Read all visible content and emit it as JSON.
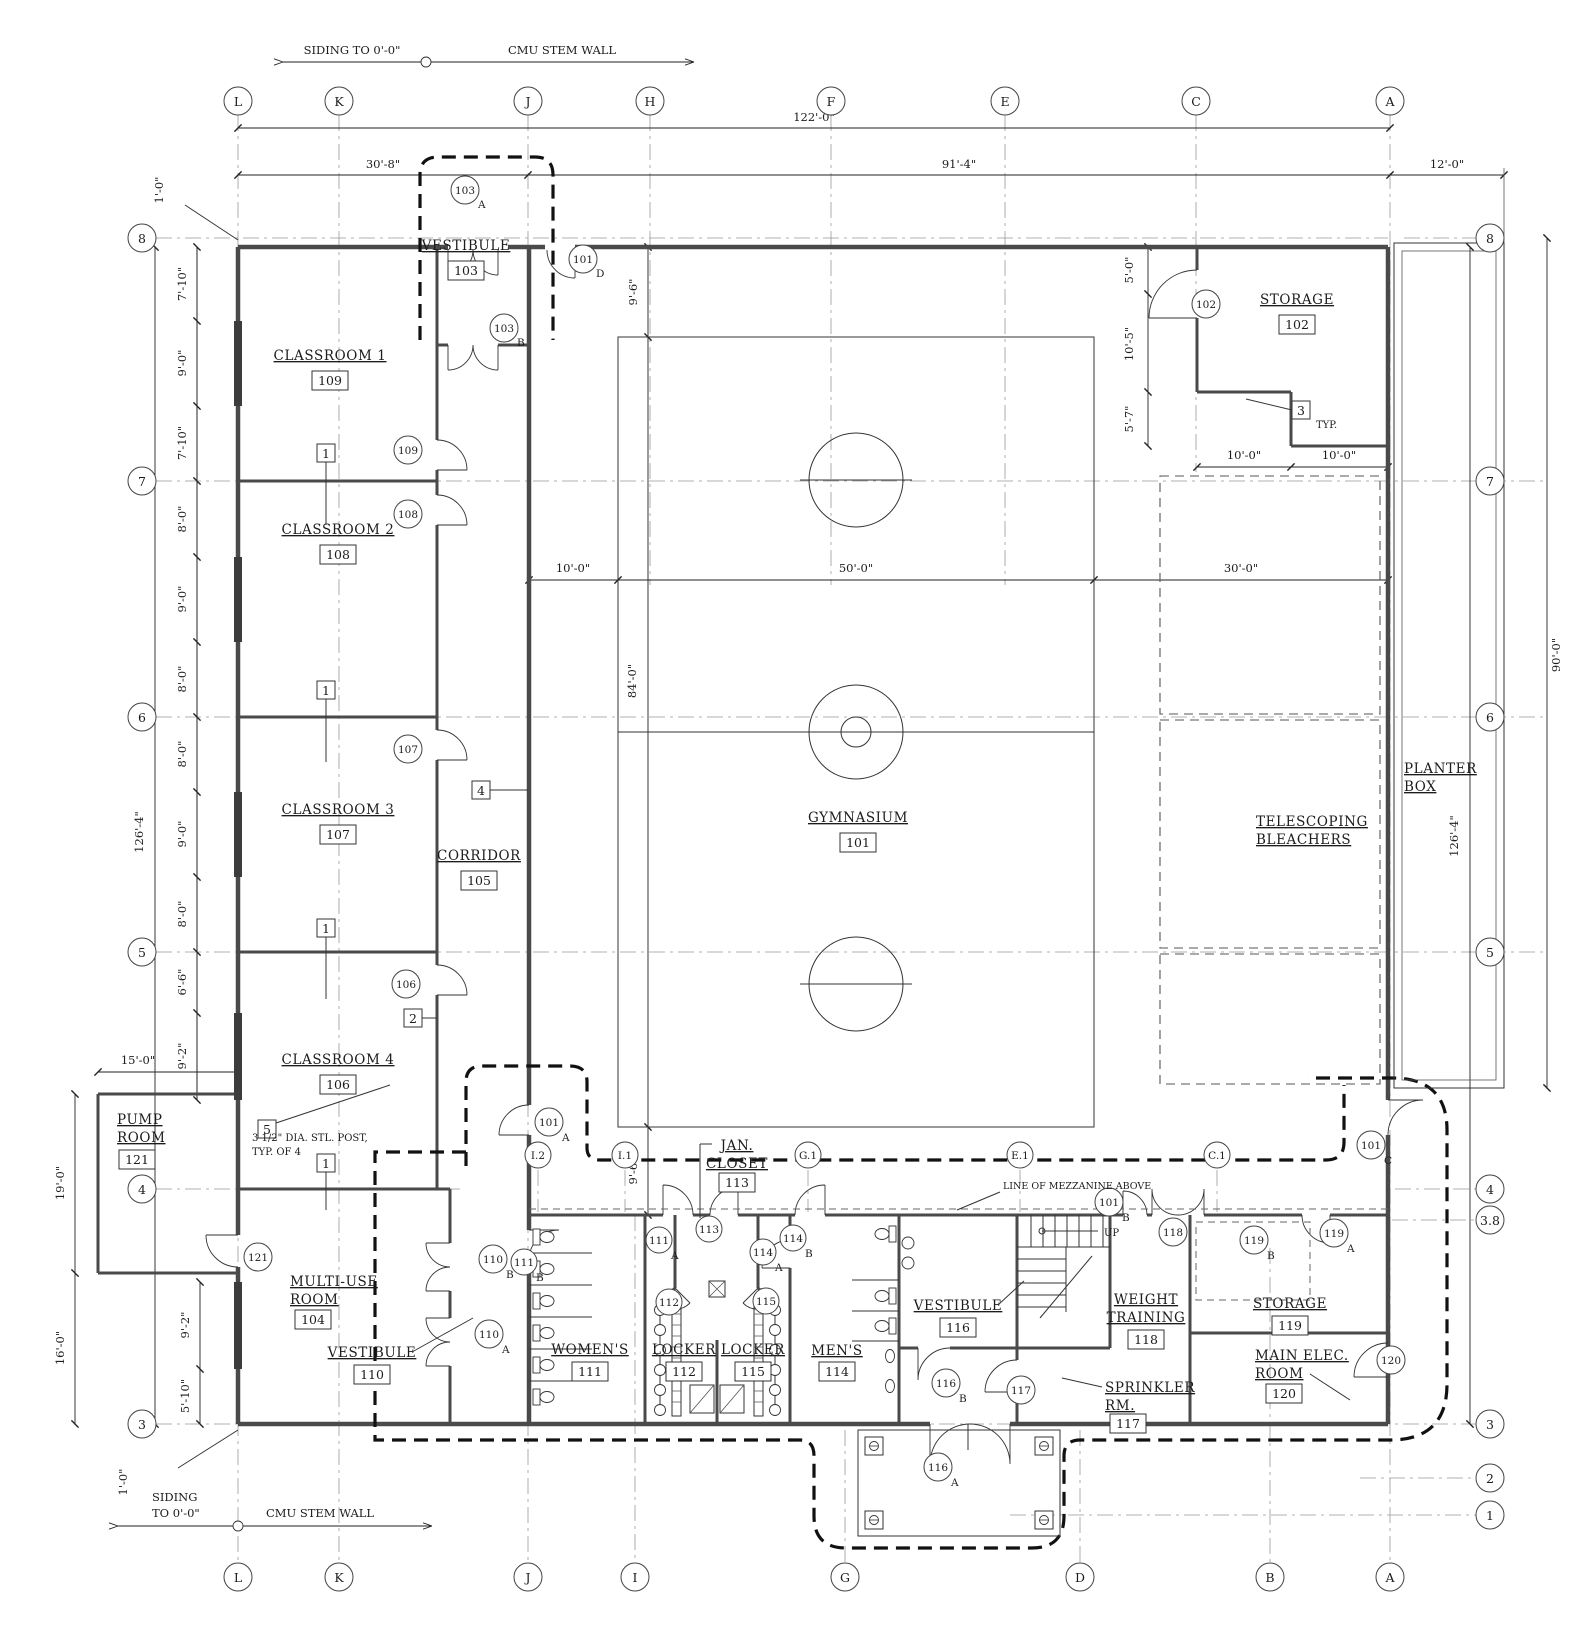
{
  "grid": {
    "top": [
      "L",
      "K",
      "J",
      "H",
      "F",
      "E",
      "C",
      "A"
    ],
    "bottom": [
      "L",
      "K",
      "J",
      "I",
      "G",
      "D",
      "B",
      "A"
    ],
    "left": [
      "8",
      "7",
      "6",
      "5",
      "4",
      "3"
    ],
    "right": [
      "8",
      "7",
      "6",
      "5",
      "4",
      "3.8",
      "3",
      "2",
      "1"
    ],
    "mid": [
      "I.2",
      "I.1",
      "G.1",
      "E.1",
      "C.1"
    ]
  },
  "rooms": {
    "gym": {
      "name": "GYMNASIUM",
      "number": "101"
    },
    "storage102": {
      "name": "STORAGE",
      "number": "102"
    },
    "vest103": {
      "name": "VESTIBULE",
      "number": "103"
    },
    "multiuse": {
      "name1": "MULTI-USE",
      "name2": "ROOM",
      "number": "104"
    },
    "corridor": {
      "name": "CORRIDOR",
      "number": "105"
    },
    "cl4": {
      "name": "CLASSROOM 4",
      "number": "106"
    },
    "cl3": {
      "name": "CLASSROOM 3",
      "number": "107"
    },
    "cl2": {
      "name": "CLASSROOM 2",
      "number": "108"
    },
    "cl1": {
      "name": "CLASSROOM 1",
      "number": "109"
    },
    "vest110": {
      "name": "VESTIBULE",
      "number": "110"
    },
    "womens": {
      "name": "WOMEN'S",
      "number": "111"
    },
    "locker112": {
      "name": "LOCKER",
      "number": "112"
    },
    "jan": {
      "name1": "JAN.",
      "name2": "CLOSET",
      "number": "113"
    },
    "mens": {
      "name": "MEN'S",
      "number": "114"
    },
    "locker115": {
      "name": "LOCKER",
      "number": "115"
    },
    "vest116": {
      "name": "VESTIBULE",
      "number": "116"
    },
    "sprinkler": {
      "name1": "SPRINKLER",
      "name2": "RM.",
      "number": "117"
    },
    "weight": {
      "name1": "WEIGHT",
      "name2": "TRAINING",
      "number": "118"
    },
    "storage119": {
      "name": "STORAGE",
      "number": "119"
    },
    "mainelec": {
      "name1": "MAIN ELEC.",
      "name2": "ROOM",
      "number": "120"
    },
    "pump": {
      "name1": "PUMP",
      "name2": "ROOM",
      "number": "121"
    },
    "planter": {
      "name1": "PLANTER",
      "name2": "BOX"
    },
    "bleachers": {
      "name1": "TELESCOPING",
      "name2": "BLEACHERS"
    }
  },
  "doors": {
    "t103A": {
      "num": "103",
      "letter": "A"
    },
    "t103B": {
      "num": "103",
      "letter": "B"
    },
    "t101D": {
      "num": "101",
      "letter": "D"
    },
    "t102": {
      "num": "102",
      "letter": ""
    },
    "t109": {
      "num": "109",
      "letter": ""
    },
    "t108": {
      "num": "108",
      "letter": ""
    },
    "t107": {
      "num": "107",
      "letter": ""
    },
    "t106": {
      "num": "106",
      "letter": ""
    },
    "t101A": {
      "num": "101",
      "letter": "A"
    },
    "t121": {
      "num": "121",
      "letter": ""
    },
    "t110B": {
      "num": "110",
      "letter": "B"
    },
    "t110A": {
      "num": "110",
      "letter": "A"
    },
    "t111B": {
      "num": "111",
      "letter": "B"
    },
    "t111A": {
      "num": "111",
      "letter": "A"
    },
    "t113": {
      "num": "113",
      "letter": ""
    },
    "t112": {
      "num": "112",
      "letter": ""
    },
    "t115": {
      "num": "115",
      "letter": ""
    },
    "t114A": {
      "num": "114",
      "letter": "A"
    },
    "t114B": {
      "num": "114",
      "letter": "B"
    },
    "t116B": {
      "num": "116",
      "letter": "B"
    },
    "t116A": {
      "num": "116",
      "letter": "A"
    },
    "t117": {
      "num": "117",
      "letter": ""
    },
    "t101B": {
      "num": "101",
      "letter": "B"
    },
    "t118": {
      "num": "118",
      "letter": ""
    },
    "t119B": {
      "num": "119",
      "letter": "B"
    },
    "t119A": {
      "num": "119",
      "letter": "A"
    },
    "t101C": {
      "num": "101",
      "letter": "C"
    },
    "t120": {
      "num": "120",
      "letter": ""
    }
  },
  "keynotes": {
    "k1": "1",
    "k2": "2",
    "k3": "3",
    "k4": "4",
    "k5": "5",
    "typ": "TYP."
  },
  "dims": {
    "top": {
      "overall": "122'-0\"",
      "left": "30'-8\"",
      "right": "91'-4\"",
      "planter": "12'-0\""
    },
    "left_chain": [
      "7'-10\"",
      "9'-0\"",
      "7'-10\"",
      "8'-0\"",
      "9'-0\"",
      "8'-0\"",
      "8'-0\"",
      "9'-0\"",
      "8'-0\"",
      "6'-6\"",
      "9'-2\""
    ],
    "left": {
      "overall": "126'-4\"",
      "one_top": "1'-0\"",
      "pump_w": "15'-0\"",
      "pump_h": "19'-0\"",
      "below_pump": "16'-0\"",
      "win1": "9'-2\"",
      "win2": "5'-10\"",
      "one_bot": "1'-0\""
    },
    "gym": {
      "margin_top": "9'-6\"",
      "w1": "10'-0\"",
      "w2": "50'-0\"",
      "w3": "30'-0\"",
      "h": "84'-0\"",
      "margin_bot": "9'-6\""
    },
    "storage": {
      "c1": "5'-0\"",
      "c2": "10'-5\"",
      "c3": "5'-7\"",
      "w1": "10'-0\"",
      "w2": "10'-0\""
    },
    "right": {
      "overall": "126'-4\"",
      "height": "90'-0\""
    }
  },
  "annotations": {
    "siding": "SIDING TO 0'-0\"",
    "cmu": "CMU STEM WALL",
    "siding1": "SIDING",
    "siding2": "TO 0'-0\"",
    "post1": "3 1/2\" DIA. STL. POST,",
    "post2": "TYP. OF 4",
    "mezzanine": "LINE OF MEZZANINE ABOVE",
    "up": "UP"
  }
}
